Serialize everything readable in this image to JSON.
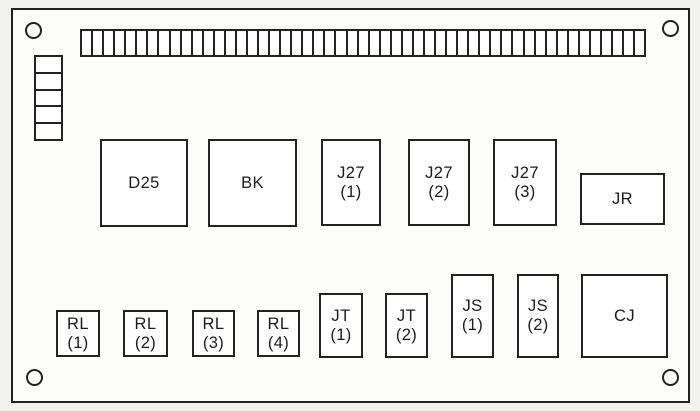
{
  "diagram": {
    "description_label": "",
    "colors": {
      "line": "#222220",
      "paper": "#f1f1ee",
      "board_fill": "#fcfcfa"
    },
    "board": {
      "mounting_holes": [
        "top-left",
        "top-right",
        "bottom-left",
        "bottom-right"
      ],
      "top_terminal_strip": {
        "cells": 51
      },
      "left_connector_stack": {
        "cells": 5
      },
      "components": [
        {
          "id": "d25",
          "lines": [
            "D25"
          ]
        },
        {
          "id": "bk",
          "lines": [
            "BK"
          ]
        },
        {
          "id": "j27-1",
          "lines": [
            "J27",
            "(1)"
          ]
        },
        {
          "id": "j27-2",
          "lines": [
            "J27",
            "(2)"
          ]
        },
        {
          "id": "j27-3",
          "lines": [
            "J27",
            "(3)"
          ]
        },
        {
          "id": "jr",
          "lines": [
            "JR"
          ]
        },
        {
          "id": "rl-1",
          "lines": [
            "RL",
            "(1)"
          ]
        },
        {
          "id": "rl-2",
          "lines": [
            "RL",
            "(2)"
          ]
        },
        {
          "id": "rl-3",
          "lines": [
            "RL",
            "(3)"
          ]
        },
        {
          "id": "rl-4",
          "lines": [
            "RL",
            "(4)"
          ]
        },
        {
          "id": "jt-1",
          "lines": [
            "JT",
            "(1)"
          ]
        },
        {
          "id": "jt-2",
          "lines": [
            "JT",
            "(2)"
          ]
        },
        {
          "id": "js-1",
          "lines": [
            "JS",
            "(1)"
          ]
        },
        {
          "id": "js-2",
          "lines": [
            "JS",
            "(2)"
          ]
        },
        {
          "id": "cj",
          "lines": [
            "CJ"
          ]
        }
      ]
    }
  }
}
